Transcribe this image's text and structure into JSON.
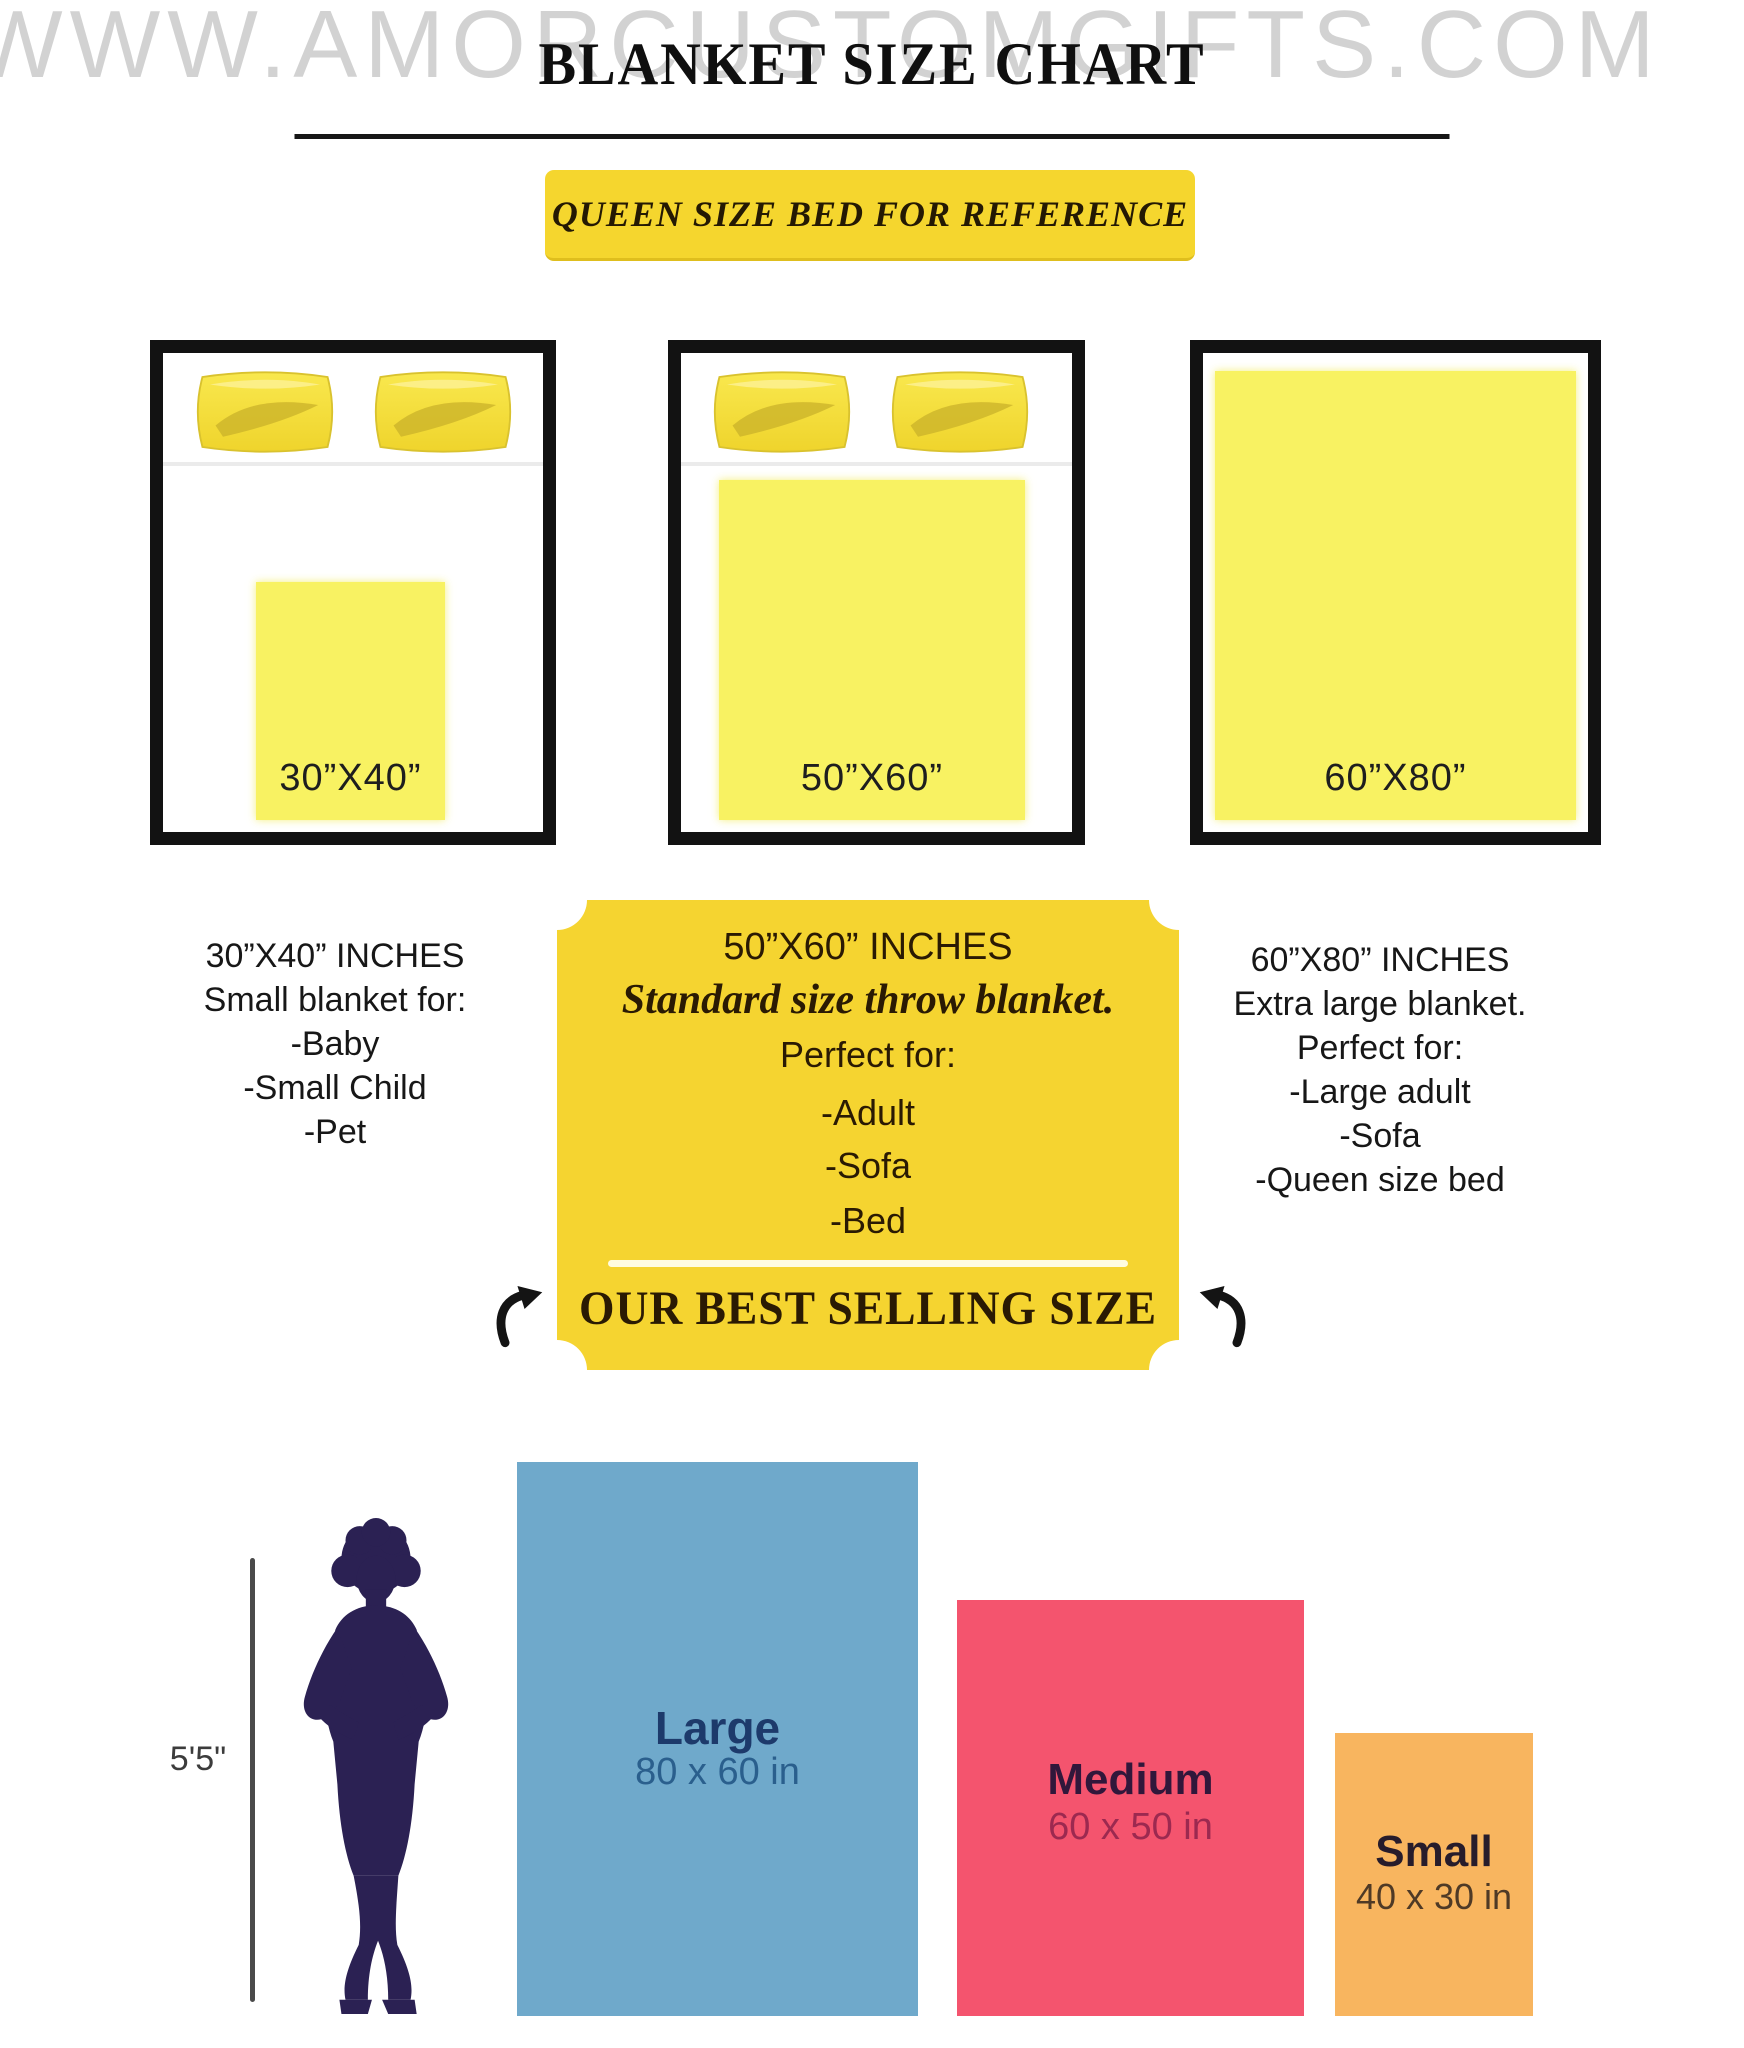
{
  "watermark": "WWW.AMORCUSTOMGIFTS.COM",
  "header": {
    "title": "BLANKET SIZE CHART",
    "badge": "QUEEN SIZE BED FOR REFERENCE"
  },
  "beds": [
    {
      "label": "30”X40”"
    },
    {
      "label": "50”X60”"
    },
    {
      "label": "60”X80”"
    }
  ],
  "columns": {
    "left": {
      "lines": [
        "30”X40” INCHES",
        "Small blanket for:",
        "-Baby",
        "-Small Child",
        "-Pet"
      ]
    },
    "center": {
      "size_line": "50”X60” INCHES",
      "subtitle": "Standard size throw blanket.",
      "perfect_for": "Perfect for:",
      "items": [
        "-Adult",
        "-Sofa",
        "-Bed"
      ],
      "highlight": "OUR BEST SELLING SIZE"
    },
    "right": {
      "lines": [
        "60”X80” INCHES",
        "Extra large blanket.",
        "Perfect for:",
        "-Large adult",
        "-Sofa",
        "-Queen size bed"
      ]
    }
  },
  "comparison": {
    "height_label": "5'5\"",
    "items": [
      {
        "name": "Large",
        "size": "80 x 60 in"
      },
      {
        "name": "Medium",
        "size": "60 x 50 in"
      },
      {
        "name": "Small",
        "size": "40 x 30 in"
      }
    ]
  },
  "colors": {
    "accent_yellow": "#F5D430",
    "badge_yellow": "#F5D62E",
    "blanket_yellow": "#F8F262",
    "large_blue": "#6FA9CB",
    "medium_pink": "#F4546E",
    "small_orange": "#F8B55F",
    "silhouette_navy": "#2B2153"
  }
}
